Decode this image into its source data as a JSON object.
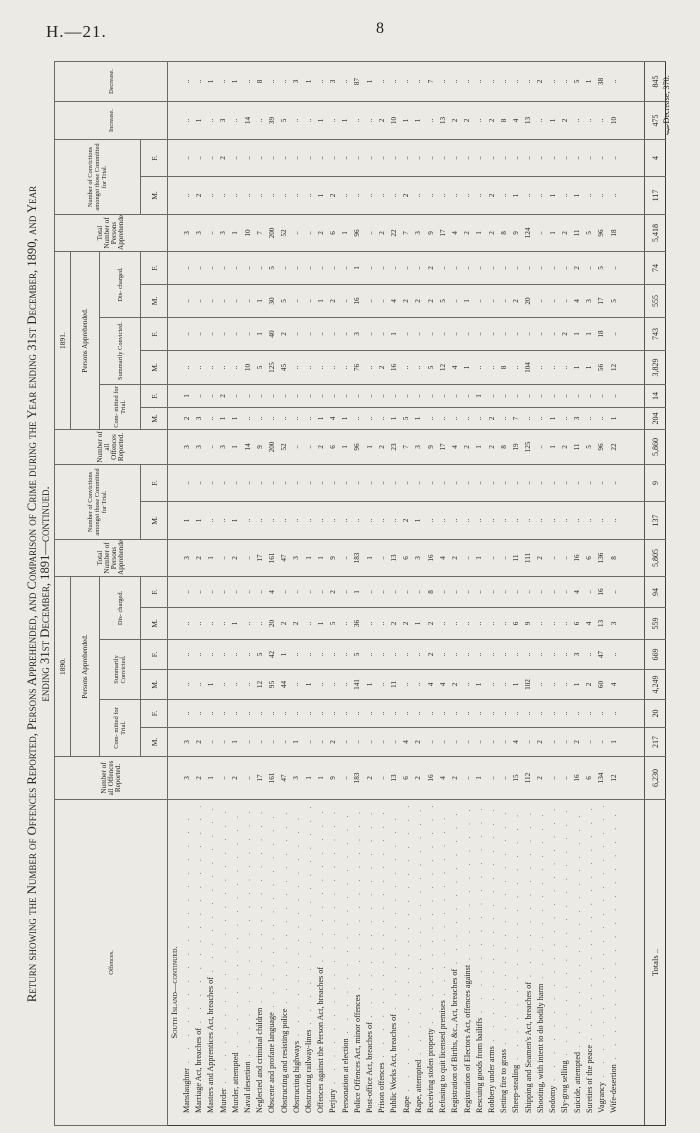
{
  "page": {
    "heading_left": "H.—21.",
    "page_number": "8"
  },
  "title": {
    "line1": "Return showing the Number of Offences Reported, Persons Apprehended, and Comparison of Crime during the Year ending 31st December, 1890, and Year",
    "line2": "ending 31st December, 1891—continued."
  },
  "table": {
    "headers": {
      "offences": "Offences.",
      "reported": "Number of all Offences Reported.",
      "year_1890": "1890.",
      "year_1891": "1891.",
      "persons_apprehended": "Persons Apprehended.",
      "committed": "Com- mitted for Trial.",
      "summarily": "Summarily Convicted.",
      "discharged": "Dis- charged.",
      "total_apprehended": "Total Number of Persons Apprehended.",
      "convictions": "Number of Convictions amongst those Committed for Trial.",
      "male": "M.",
      "female": "F.",
      "increase": "Increase.",
      "decrease": "Decrease."
    },
    "column_order_note": "each row: reported1890, committedM, committedF, summarilyM, summarilyF, dischargedM, dischargedF, totalApprehended, convictionsM, convictionsF (1890), then same ten for 1891, then increase, decrease",
    "section_heading": "South Island—continued.",
    "rows": [
      {
        "offence": "Manslaughter",
        "v": [
          "3",
          "3",
          "..",
          "..",
          "..",
          "..",
          "..",
          "3",
          "1",
          "..",
          "3",
          "2",
          "1",
          "..",
          "..",
          "..",
          "..",
          "3",
          "..",
          "..",
          "..",
          ".."
        ]
      },
      {
        "offence": "Marriage Act, breaches of",
        "v": [
          "2",
          "2",
          "..",
          "..",
          "..",
          "..",
          "..",
          "2",
          "1",
          "..",
          "3",
          "3",
          "..",
          "..",
          "..",
          "..",
          "..",
          "3",
          "2",
          "..",
          "1",
          ".."
        ]
      },
      {
        "offence": "Masters and Apprentices Act, breaches of",
        "v": [
          "1",
          "..",
          "..",
          "1",
          "..",
          "..",
          "..",
          "1",
          "..",
          "..",
          "..",
          "..",
          "..",
          "..",
          "..",
          "..",
          "..",
          "..",
          "..",
          "..",
          "..",
          "1"
        ]
      },
      {
        "offence": "Murder",
        "v": [
          "..",
          "..",
          "..",
          "..",
          "..",
          "..",
          "..",
          "..",
          "..",
          "..",
          "3",
          "1",
          "2",
          "..",
          "..",
          "..",
          "..",
          "3",
          "..",
          "2",
          "3",
          ".."
        ]
      },
      {
        "offence": "Murder, attempted",
        "v": [
          "2",
          "1",
          "..",
          "..",
          "..",
          "1",
          "..",
          "2",
          "1",
          "..",
          "1",
          "1",
          "..",
          "..",
          "..",
          "..",
          "..",
          "1",
          "..",
          "..",
          "..",
          "1"
        ]
      },
      {
        "offence": "Naval desertion",
        "v": [
          "..",
          "..",
          "..",
          "..",
          "..",
          "..",
          "..",
          "..",
          "..",
          "..",
          "14",
          "..",
          "..",
          "10",
          "..",
          "..",
          "..",
          "10",
          "..",
          "..",
          "14",
          ".."
        ]
      },
      {
        "offence": "Neglected and criminal children",
        "v": [
          "17",
          "..",
          "..",
          "12",
          "5",
          "..",
          "..",
          "17",
          "..",
          "..",
          "9",
          "..",
          "..",
          "5",
          "1",
          "1",
          "..",
          "7",
          "..",
          "..",
          "..",
          "8"
        ]
      },
      {
        "offence": "Obscene and profane language",
        "v": [
          "161",
          "..",
          "..",
          "95",
          "42",
          "20",
          "4",
          "161",
          "..",
          "..",
          "200",
          "..",
          "..",
          "125",
          "40",
          "30",
          "5",
          "200",
          "..",
          "..",
          "39",
          ".."
        ]
      },
      {
        "offence": "Obstructing and resisting police",
        "v": [
          "47",
          "..",
          "..",
          "44",
          "1",
          "2",
          "..",
          "47",
          "..",
          "..",
          "52",
          "..",
          "..",
          "45",
          "2",
          "5",
          "..",
          "52",
          "..",
          "..",
          "5",
          ".."
        ]
      },
      {
        "offence": "Obstructing highways",
        "v": [
          "3",
          "1",
          "..",
          "..",
          "..",
          "2",
          "..",
          "3",
          "..",
          "..",
          "..",
          "..",
          "..",
          "..",
          "..",
          "..",
          "..",
          "..",
          "..",
          "..",
          "..",
          "3"
        ]
      },
      {
        "offence": "Obstructing railway-lines",
        "v": [
          "1",
          "..",
          "..",
          "1",
          "..",
          "..",
          "..",
          "1",
          "..",
          "..",
          "..",
          "..",
          "..",
          "..",
          "..",
          "..",
          "..",
          "..",
          "..",
          "..",
          "..",
          "1"
        ]
      },
      {
        "offence": "Offences against the Person Act, breaches of",
        "v": [
          "1",
          "..",
          "..",
          "..",
          "..",
          "1",
          "..",
          "1",
          "..",
          "..",
          "2",
          "1",
          "..",
          "..",
          "..",
          "1",
          "..",
          "2",
          "1",
          "..",
          "1",
          ".."
        ]
      },
      {
        "offence": "Perjury",
        "v": [
          "9",
          "2",
          "..",
          "..",
          "..",
          "5",
          "2",
          "9",
          "..",
          "..",
          "6",
          "4",
          "..",
          "..",
          "..",
          "2",
          "..",
          "6",
          "2",
          "..",
          "..",
          "3"
        ]
      },
      {
        "offence": "Personation at election",
        "v": [
          "..",
          "..",
          "..",
          "..",
          "..",
          "..",
          "..",
          "..",
          "..",
          "..",
          "1",
          "1",
          "..",
          "..",
          "..",
          "..",
          "..",
          "1",
          "..",
          "..",
          "1",
          ".."
        ]
      },
      {
        "offence": "Police Offences Act, minor offences",
        "v": [
          "183",
          "..",
          "..",
          "141",
          "5",
          "36",
          "1",
          "183",
          "..",
          "..",
          "96",
          "..",
          "..",
          "76",
          "3",
          "16",
          "1",
          "96",
          "..",
          "..",
          "..",
          "87"
        ]
      },
      {
        "offence": "Post-office Act, breaches of",
        "v": [
          "2",
          "..",
          "..",
          "1",
          "..",
          "..",
          "..",
          "1",
          "..",
          "..",
          "1",
          "..",
          "..",
          "..",
          "..",
          "..",
          "..",
          "..",
          "..",
          "..",
          "..",
          "1"
        ]
      },
      {
        "offence": "Prison offences",
        "v": [
          "..",
          "..",
          "..",
          "..",
          "..",
          "..",
          "..",
          "..",
          "..",
          "..",
          "2",
          "..",
          "..",
          "2",
          "..",
          "..",
          "..",
          "2",
          "..",
          "..",
          "2",
          ".."
        ]
      },
      {
        "offence": "Public Works Act, breaches of",
        "v": [
          "13",
          "..",
          "..",
          "11",
          "..",
          "2",
          "..",
          "13",
          "..",
          "..",
          "23",
          "1",
          "..",
          "16",
          "1",
          "4",
          "..",
          "22",
          "..",
          "..",
          "10",
          ".."
        ]
      },
      {
        "offence": "Rape",
        "v": [
          "6",
          "4",
          "..",
          "..",
          "..",
          "2",
          "..",
          "6",
          "2",
          "..",
          "7",
          "5",
          "..",
          "..",
          "..",
          "2",
          "..",
          "7",
          "2",
          "..",
          "1",
          ".."
        ]
      },
      {
        "offence": "Rape, attempted",
        "v": [
          "2",
          "2",
          "..",
          "..",
          "..",
          "1",
          "..",
          "3",
          "1",
          "..",
          "3",
          "1",
          "..",
          "..",
          "..",
          "2",
          "..",
          "3",
          "..",
          "..",
          "1",
          ".."
        ]
      },
      {
        "offence": "Receiving stolen property",
        "v": [
          "16",
          "..",
          "..",
          "4",
          "2",
          "2",
          "8",
          "16",
          "..",
          "..",
          "9",
          "..",
          "..",
          "5",
          "..",
          "2",
          "2",
          "9",
          "..",
          "..",
          "..",
          "7"
        ]
      },
      {
        "offence": "Refusing to quit licensed premises",
        "v": [
          "4",
          "..",
          "..",
          "4",
          "..",
          "..",
          "..",
          "4",
          "..",
          "..",
          "17",
          "..",
          "..",
          "12",
          "..",
          "5",
          "..",
          "17",
          "..",
          "..",
          "13",
          ".."
        ]
      },
      {
        "offence": "Registration of Births, &c., Act, breaches of",
        "v": [
          "2",
          "..",
          "..",
          "2",
          "..",
          "..",
          "..",
          "2",
          "..",
          "..",
          "4",
          "..",
          "..",
          "4",
          "..",
          "..",
          "..",
          "4",
          "..",
          "..",
          "2",
          ".."
        ]
      },
      {
        "offence": "Registration of Electors Act, offences against",
        "v": [
          "..",
          "..",
          "..",
          "..",
          "..",
          "..",
          "..",
          "..",
          "..",
          "..",
          "2",
          "..",
          "..",
          "1",
          "..",
          "1",
          "..",
          "2",
          "..",
          "..",
          "2",
          ".."
        ]
      },
      {
        "offence": "Rescuing goods from bailiffs",
        "v": [
          "1",
          "..",
          "..",
          "1",
          "..",
          "..",
          "..",
          "1",
          "..",
          "..",
          "1",
          "..",
          "1",
          "..",
          "..",
          "..",
          "..",
          "1",
          "..",
          "..",
          "..",
          ".."
        ]
      },
      {
        "offence": "Robbery under arms",
        "v": [
          "..",
          "..",
          "..",
          "..",
          "..",
          "..",
          "..",
          "..",
          "..",
          "..",
          "2",
          "2",
          "..",
          "..",
          "..",
          "..",
          "..",
          "2",
          "2",
          "..",
          "2",
          ".."
        ]
      },
      {
        "offence": "Setting fire to grass",
        "v": [
          "..",
          "..",
          "..",
          "..",
          "..",
          "..",
          "..",
          "..",
          "..",
          "..",
          "8",
          "..",
          "..",
          "8",
          "..",
          "..",
          "..",
          "8",
          "..",
          "..",
          "8",
          ".."
        ]
      },
      {
        "offence": "Sheep-stealing",
        "v": [
          "15",
          "4",
          "..",
          "1",
          "..",
          "6",
          "..",
          "11",
          "..",
          "..",
          "19",
          "7",
          "..",
          "..",
          "..",
          "2",
          "..",
          "9",
          "1",
          "..",
          "4",
          ".."
        ]
      },
      {
        "offence": "Shipping and Seamen's Act, breaches of",
        "v": [
          "112",
          "..",
          "..",
          "102",
          "..",
          "9",
          "..",
          "111",
          "..",
          "..",
          "125",
          "..",
          "..",
          "104",
          "..",
          "20",
          "..",
          "124",
          "..",
          "..",
          "13",
          ".."
        ]
      },
      {
        "offence": "Shooting, with intent to do bodily harm",
        "v": [
          "2",
          "2",
          "..",
          "..",
          "..",
          "..",
          "..",
          "2",
          "..",
          "..",
          "..",
          "..",
          "..",
          "..",
          "..",
          "..",
          "..",
          "..",
          "..",
          "..",
          "..",
          "2"
        ]
      },
      {
        "offence": "Sodomy",
        "v": [
          "..",
          "..",
          "..",
          "..",
          "..",
          "..",
          "..",
          "..",
          "..",
          "..",
          "1",
          "1",
          "..",
          "..",
          "..",
          "..",
          "..",
          "1",
          "1",
          "..",
          "1",
          ".."
        ]
      },
      {
        "offence": "Sly-grog selling",
        "v": [
          "..",
          "..",
          "..",
          "..",
          "..",
          "..",
          "..",
          "..",
          "..",
          "..",
          "2",
          "..",
          "..",
          "..",
          "2",
          "..",
          "..",
          "2",
          "..",
          "..",
          "2",
          ".."
        ]
      },
      {
        "offence": "Suicide, attempted",
        "v": [
          "16",
          "2",
          "..",
          "1",
          "3",
          "6",
          "4",
          "16",
          "..",
          "..",
          "11",
          "3",
          "..",
          "1",
          "1",
          "4",
          "2",
          "11",
          "1",
          "..",
          "..",
          "5"
        ]
      },
      {
        "offence": "Sureties of the peace",
        "v": [
          "6",
          "..",
          "..",
          "2",
          "..",
          "4",
          "..",
          "6",
          "..",
          "..",
          "5",
          "..",
          "..",
          "1",
          "1",
          "3",
          "..",
          "5",
          "..",
          "..",
          "..",
          "1"
        ]
      },
      {
        "offence": "Vagrancy",
        "v": [
          "134",
          "..",
          "..",
          "60",
          "47",
          "13",
          "16",
          "136",
          "..",
          "..",
          "96",
          "..",
          "..",
          "56",
          "18",
          "17",
          "5",
          "96",
          "..",
          "..",
          "..",
          "38"
        ]
      },
      {
        "offence": "Wife-desertion",
        "v": [
          "12",
          "1",
          "..",
          "4",
          "..",
          "3",
          "..",
          "8",
          "..",
          "..",
          "22",
          "1",
          "..",
          "12",
          "..",
          "5",
          "..",
          "18",
          "..",
          "..",
          "10",
          ".."
        ]
      }
    ],
    "totals": {
      "label": "Totals",
      "v": [
        "6,230",
        "217",
        "20",
        "4,249",
        "669",
        "559",
        "94",
        "5,805",
        "137",
        "9",
        "5,860",
        "204",
        "14",
        "3,829",
        "743",
        "555",
        "74",
        "5,418",
        "117",
        "4",
        "475",
        "845"
      ]
    },
    "footnote": "Decrease, 370."
  }
}
